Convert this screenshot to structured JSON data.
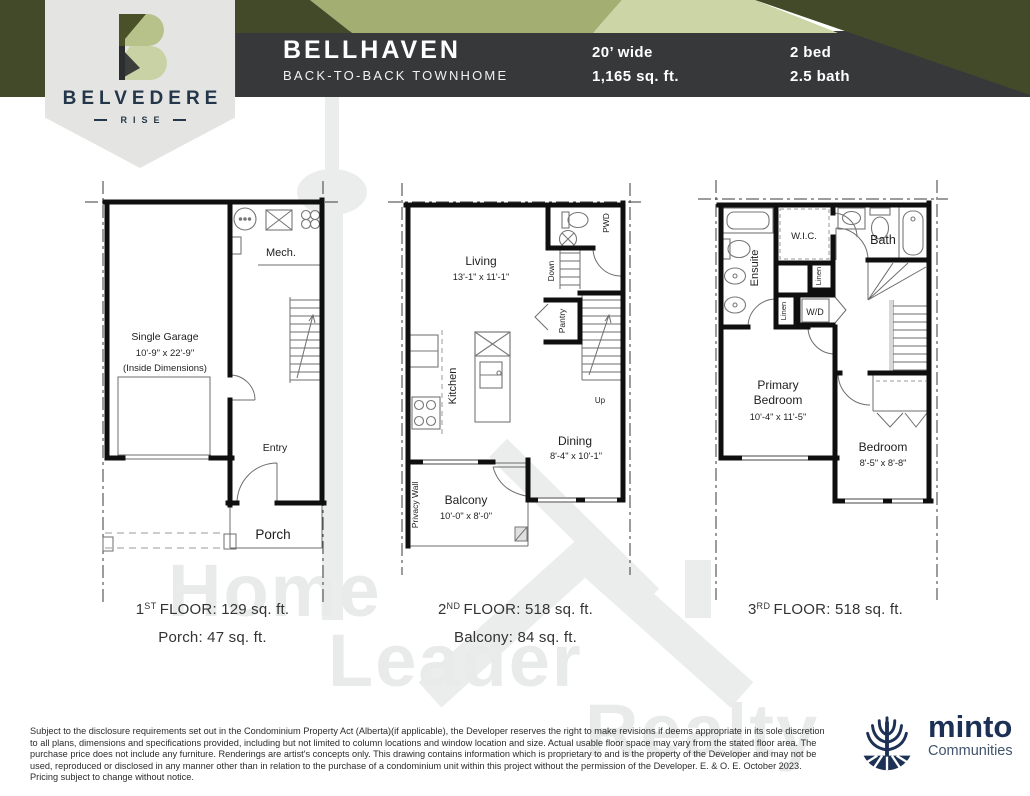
{
  "header": {
    "badge": {
      "name": "BELVEDERE",
      "sub": "RISE"
    },
    "model": {
      "name": "BELLHAVEN",
      "type": "BACK-TO-BACK TOWNHOME"
    },
    "specs": {
      "width": "20’ wide",
      "area": "1,165  sq. ft.",
      "bed": "2 bed",
      "bath": "2.5 bath"
    }
  },
  "plans": [
    {
      "id": "first-floor",
      "caption": {
        "num": "1",
        "ord": "ST",
        "text": "FLOOR: 129  sq. ft.",
        "sub": "Porch: 47 sq. ft."
      },
      "rooms": {
        "mech": "Mech.",
        "garage1": "Single Garage",
        "garage2": "10'-9\" x 22'-9\"",
        "garage3": "(Inside Dimensions)",
        "entry": "Entry",
        "porch": "Porch"
      }
    },
    {
      "id": "second-floor",
      "caption": {
        "num": "2",
        "ord": "ND",
        "text": "FLOOR: 518  sq. ft.",
        "sub": "Balcony: 84 sq. ft."
      },
      "rooms": {
        "living": "Living",
        "living_dim": "13'-1\" x 11'-1\"",
        "pwd": "PWD",
        "down": "Down",
        "pantry": "Pantry",
        "kitchen": "Kitchen",
        "dining": "Dining",
        "dining_dim": "8'-4\" x 10'-1\"",
        "up": "Up",
        "privacy": "Privacy Wall",
        "balcony": "Balcony",
        "balcony_dim": "10'-0\" x 8'-0\""
      }
    },
    {
      "id": "third-floor",
      "caption": {
        "num": "3",
        "ord": "RD",
        "text": "FLOOR: 518  sq. ft.",
        "sub": ""
      },
      "rooms": {
        "ensuite": "Ensuite",
        "wic": "W.I.C.",
        "bath": "Bath",
        "linen1": "Linen",
        "linen2": "Linen",
        "wd": "W/D",
        "primary1": "Primary",
        "primary2": "Bedroom",
        "primary_dim": "10'-4\" x 11'-5\"",
        "bedroom": "Bedroom",
        "bedroom_dim": "8'-5\" x 8'-8\""
      }
    }
  ],
  "watermark": {
    "line1": "Home",
    "line2": "Leader",
    "line3": "Realty"
  },
  "footer": {
    "disclaimer": "Subject to the disclosure requirements set out in the Condominium Property Act (Alberta)(if applicable), the Developer reserves the right to make revisions if deems appropriate in its sole discretion to all plans, dimensions and specifications provided, including but not limited to column locations and window location and size. Actual usable floor space may vary from the stated floor area. The purchase price does not include any furniture. Renderings are artist's concepts only. This drawing contains information which is proprietary to and is the property of the Developer and may not be used, reproduced or disclosed in any manner other than in relation to the purchase of a condominium unit within this project without the permission of the Developer. E. & O. E. October 2023. Pricing subject to change without notice.",
    "brand": "minto",
    "brand_sub": "Communities"
  },
  "colors": {
    "dark_olive": "#434a29",
    "sage": "#a3ae73",
    "light_sage": "#ccd5a5",
    "charcoal": "#37383a",
    "belvedere_navy": "#24364a",
    "minto_navy": "#1d3156",
    "watermark_gray": "#e9eaea"
  }
}
